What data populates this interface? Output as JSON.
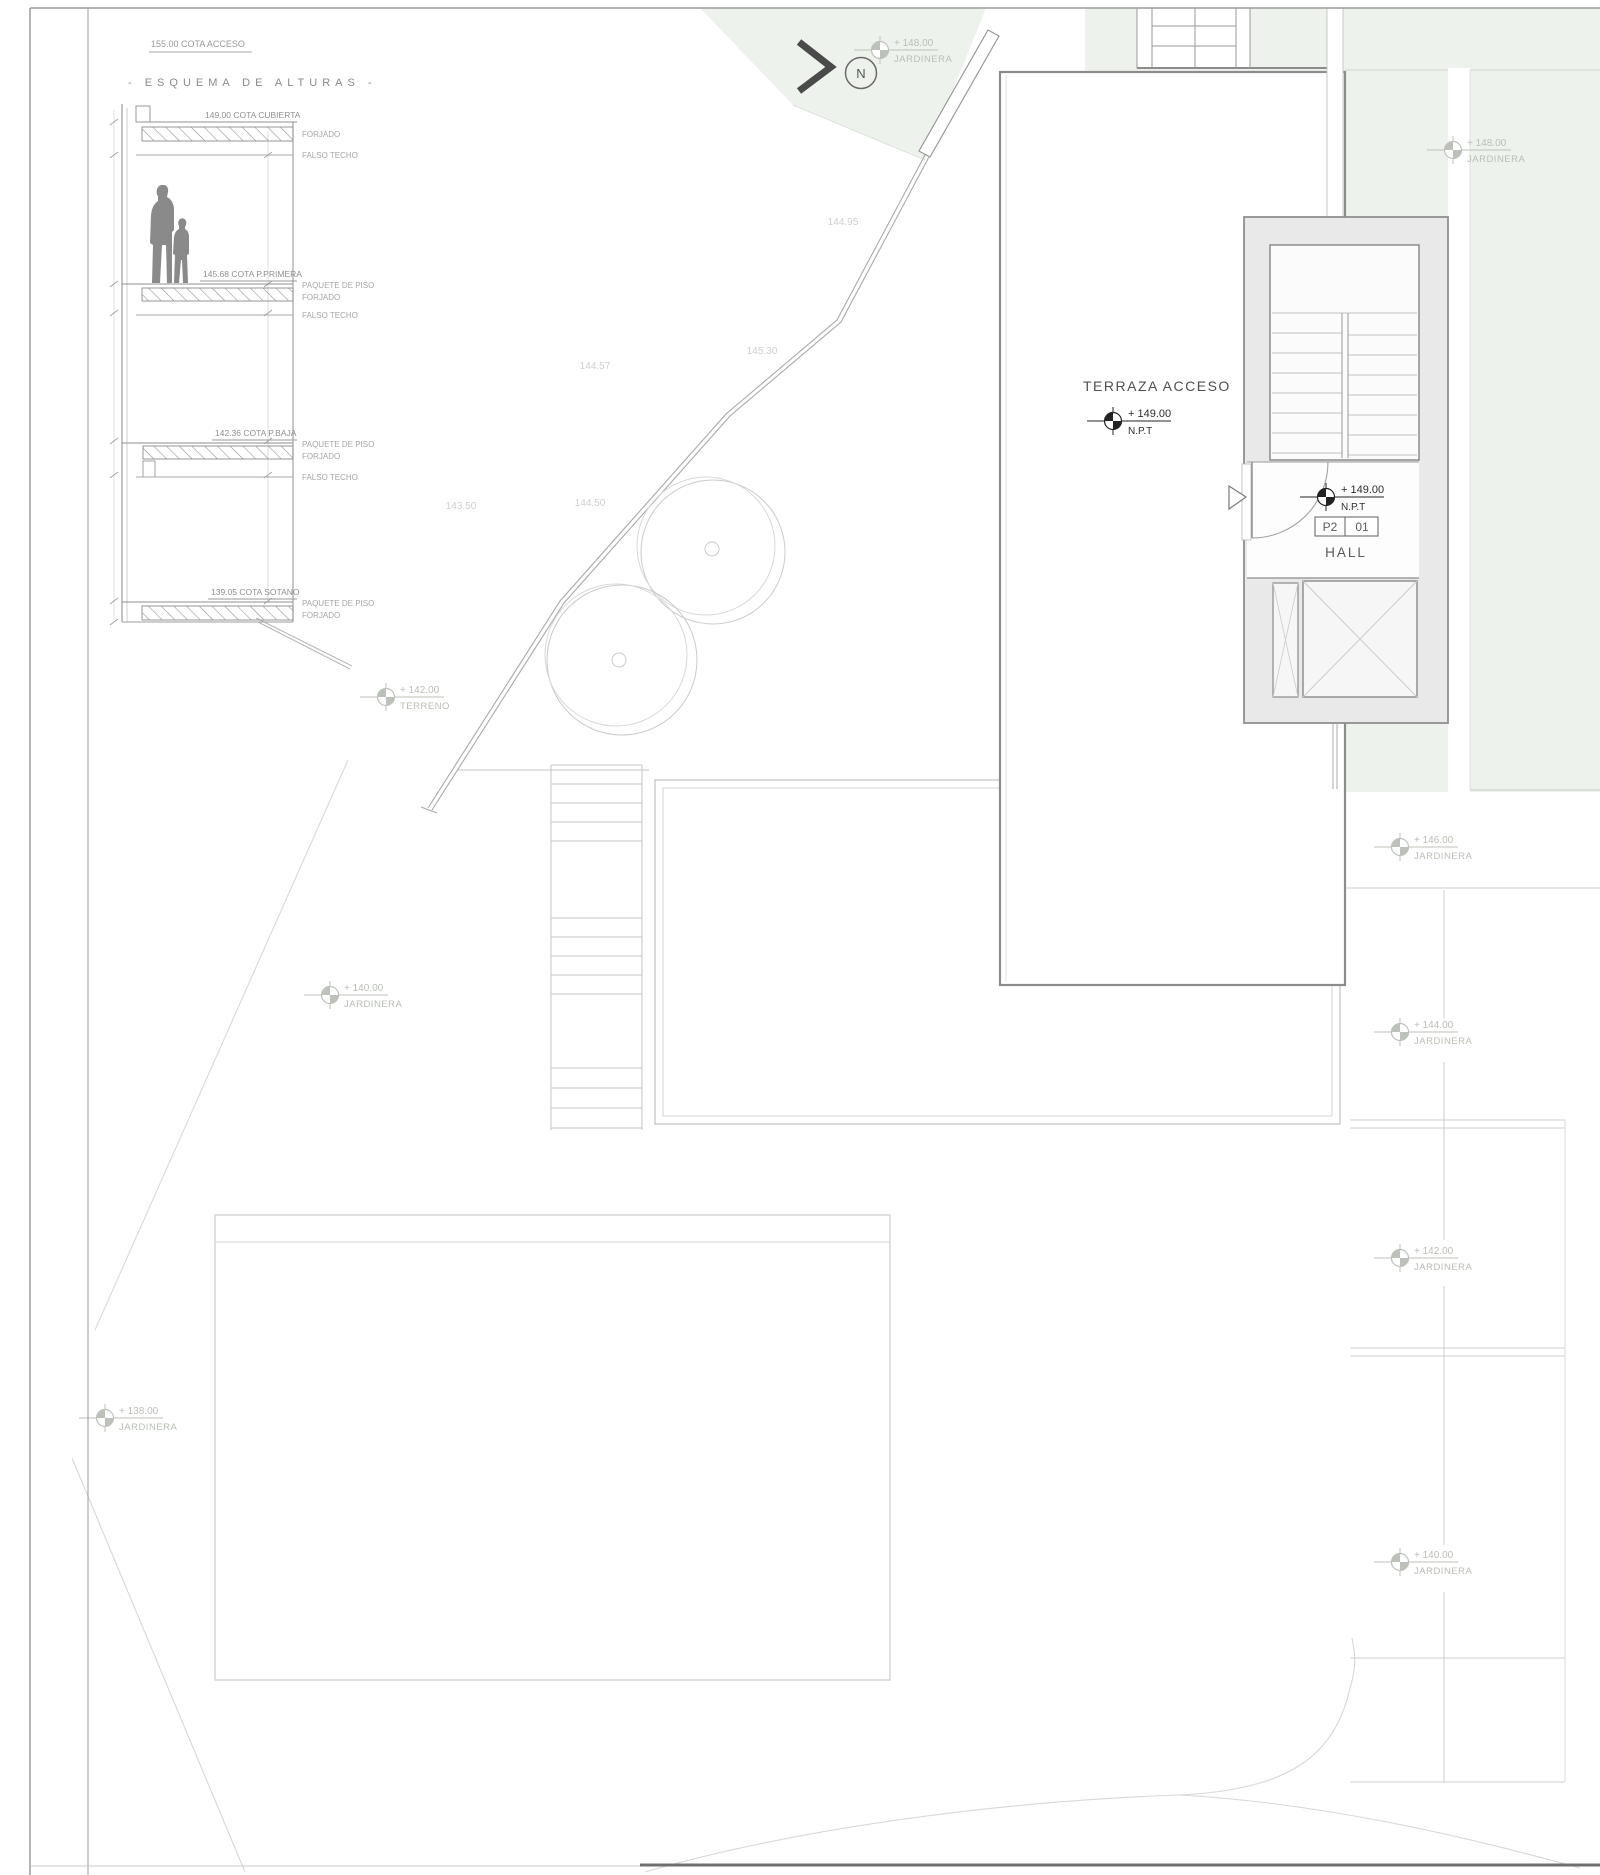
{
  "drawing": {
    "section": {
      "access_note": "155.00 COTA ACCESO",
      "title": "- ESQUEMA DE ALTURAS -",
      "levels": [
        {
          "cota": "149.00 COTA CUBIERTA",
          "l0": "FORJADO",
          "l1": "FALSO TECHO"
        },
        {
          "cota": "145.68 COTA P.PRIMERA",
          "l0": "PAQUETE DE PISO",
          "l1": "FORJADO",
          "l2": "FALSO TECHO"
        },
        {
          "cota": "142.36 COTA P.BAJA",
          "l0": "PAQUETE DE PISO",
          "l1": "FORJADO",
          "l2": "FALSO TECHO"
        },
        {
          "cota": "139.05 COTA SOTANO",
          "l0": "PAQUETE DE PISO",
          "l1": "FORJADO"
        }
      ]
    },
    "plan": {
      "north_label": "N",
      "terrace_label": "TERRAZA ACCESO",
      "terrace_level": {
        "value": "+ 149.00",
        "sub": "N.P.T"
      },
      "hall_level": {
        "value": "+ 149.00",
        "sub": "N.P.T"
      },
      "room_tag": {
        "zone": "P2",
        "number": "01",
        "name": "HALL"
      },
      "markers": [
        {
          "value": "+ 148.00",
          "label": "JARDINERA"
        },
        {
          "value": "+ 148.00",
          "label": "JARDINERA"
        },
        {
          "value": "+ 142.00",
          "label": "TERRENO"
        },
        {
          "value": "+ 140.00",
          "label": "JARDINERA"
        },
        {
          "value": "+ 138.00",
          "label": "JARDINERA"
        },
        {
          "value": "+ 146.00",
          "label": "JARDINERA"
        },
        {
          "value": "+ 144.00",
          "label": "JARDINERA"
        },
        {
          "value": "+ 142.00",
          "label": "JARDINERA"
        },
        {
          "value": "+ 140.00",
          "label": "JARDINERA"
        }
      ],
      "contours": [
        "144.95",
        "145.30",
        "144.57",
        "144.50",
        "143.50"
      ]
    },
    "colors": {
      "planter_green": "#eef2ec",
      "marker_dark": "#232323",
      "marker_faint": "#bcc2ba",
      "block_gray": "#e9e9e9"
    }
  }
}
